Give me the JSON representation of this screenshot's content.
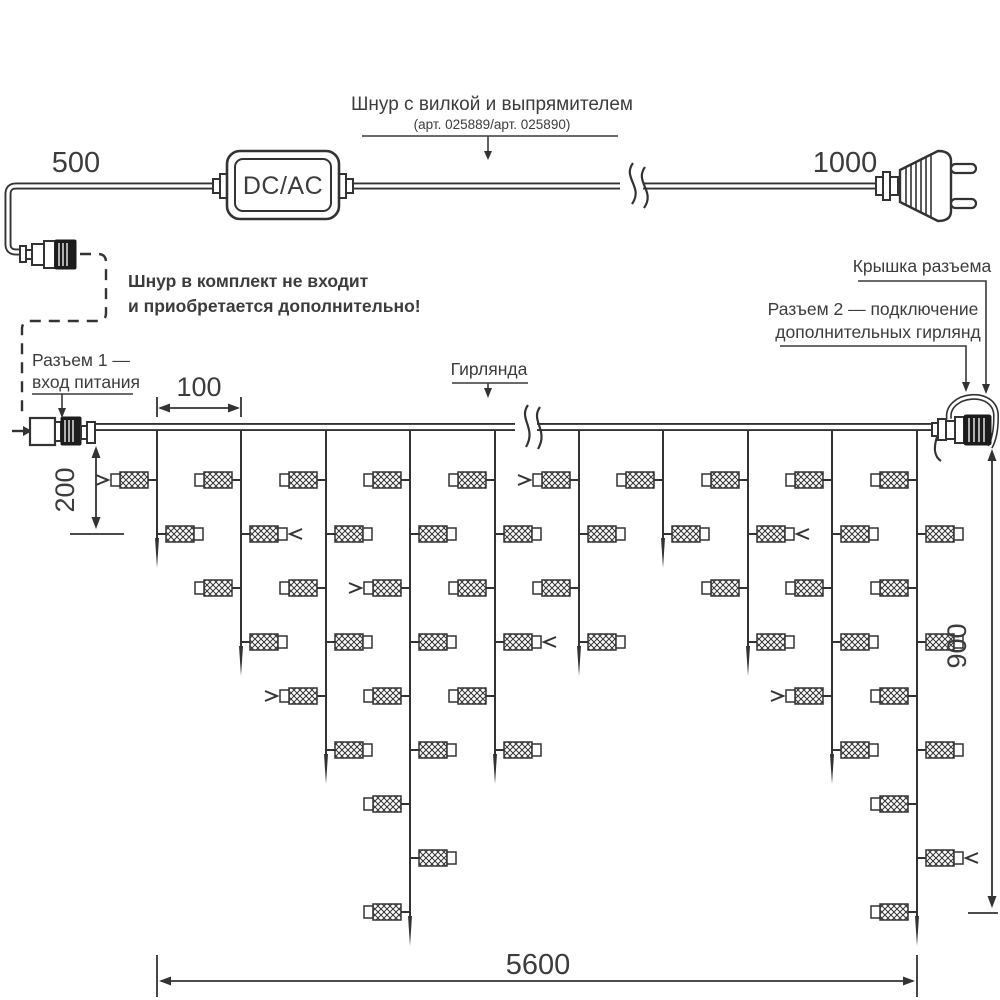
{
  "dims": {
    "d500": "500",
    "d1000": "1000",
    "d100": "100",
    "d200": "200",
    "d900": "900",
    "d5600": "5600"
  },
  "labels": {
    "cord": "Шнур с вилкой и выпрямителем",
    "cord_art": "(арт. 025889/арт. 025890)",
    "dcac": "DC/AC",
    "note1": "Шнур в комплект не входит",
    "note2": "и приобретается дополнительно!",
    "conn1a": "Разъем 1 —",
    "conn1b": "вход питания",
    "garland": "Гирлянда",
    "cap": "Крышка разъема",
    "conn2a": "Разъем 2 — подключение",
    "conn2b": "дополнительных гирлянд"
  },
  "colors": {
    "line": "#333333",
    "text": "#3c3c3c",
    "background": "#ffffff"
  },
  "garland": {
    "main_y": 427,
    "x_start": 95,
    "x_end": 935,
    "strand_xs": [
      157,
      241,
      326,
      410,
      495,
      579,
      663,
      748,
      832,
      917
    ],
    "led_counts": [
      2,
      4,
      6,
      9,
      6,
      4,
      2,
      4,
      6,
      9
    ],
    "led_first_y": 480,
    "led_spacing": 54,
    "tip_extra": 34,
    "arrows": [
      {
        "strand": 0,
        "led": 0,
        "dir": "right"
      },
      {
        "strand": 1,
        "led": 1,
        "dir": "left"
      },
      {
        "strand": 2,
        "led": 4,
        "dir": "right"
      },
      {
        "strand": 3,
        "led": 2,
        "dir": "right"
      },
      {
        "strand": 4,
        "led": 3,
        "dir": "left"
      },
      {
        "strand": 5,
        "led": 0,
        "dir": "right"
      },
      {
        "strand": 7,
        "led": 1,
        "dir": "left"
      },
      {
        "strand": 8,
        "led": 4,
        "dir": "right"
      },
      {
        "strand": 9,
        "led": 7,
        "dir": "left"
      }
    ]
  }
}
